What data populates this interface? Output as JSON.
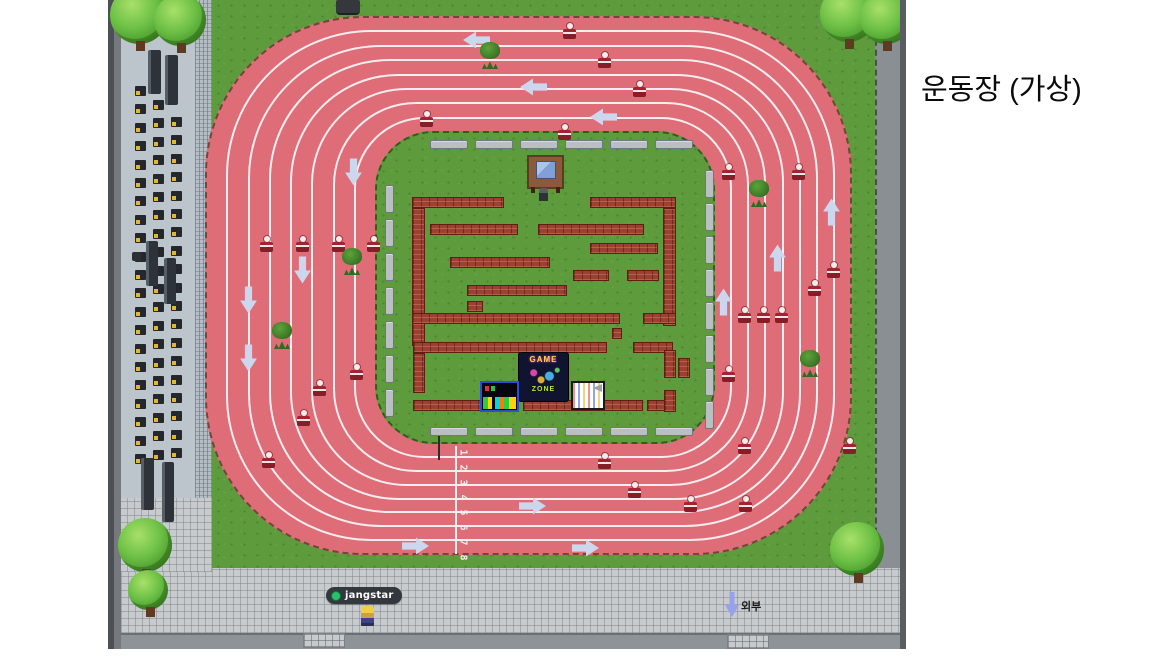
{
  "title": {
    "text": "운동장 (가상)"
  },
  "player": {
    "name": "jangstar",
    "status_color": "#27c06b"
  },
  "exit": {
    "label": "외부"
  },
  "sign": {
    "game": "GAME",
    "zone": "ZONE"
  },
  "track": {
    "lanes": 8,
    "lane_numbers": [
      "1",
      "2",
      "3",
      "4",
      "5",
      "6",
      "7",
      "8"
    ],
    "number_x": 352,
    "number_y0": 447,
    "number_step": 15
  },
  "colors": {
    "track": "#df6d78",
    "grass": "#5d9b3d",
    "lane": "#f6edef",
    "arrow": "#ccd7ee",
    "hurdle": "#a32430",
    "brick": "#9c4132",
    "status": "#27c06b"
  },
  "sprites": {
    "hurdles": [
      [
        455,
        27
      ],
      [
        490,
        56
      ],
      [
        525,
        85
      ],
      [
        312,
        115
      ],
      [
        450,
        128
      ],
      [
        152,
        240
      ],
      [
        188,
        240
      ],
      [
        224,
        240
      ],
      [
        259,
        240
      ],
      [
        242,
        368
      ],
      [
        205,
        384
      ],
      [
        189,
        414
      ],
      [
        154,
        456
      ],
      [
        490,
        457
      ],
      [
        520,
        486
      ],
      [
        576,
        500
      ],
      [
        631,
        500
      ],
      [
        614,
        168
      ],
      [
        684,
        168
      ],
      [
        719,
        266
      ],
      [
        700,
        284
      ],
      [
        630,
        311
      ],
      [
        649,
        311
      ],
      [
        667,
        311
      ],
      [
        614,
        370
      ],
      [
        630,
        442
      ],
      [
        735,
        442
      ]
    ],
    "arrows": [
      {
        "d": "left",
        "x": 355,
        "y": 30
      },
      {
        "d": "left",
        "x": 412,
        "y": 77
      },
      {
        "d": "left",
        "x": 482,
        "y": 107
      },
      {
        "d": "down",
        "x": 232,
        "y": 162
      },
      {
        "d": "down",
        "x": 181,
        "y": 260
      },
      {
        "d": "down",
        "x": 127,
        "y": 290
      },
      {
        "d": "down",
        "x": 127,
        "y": 348
      },
      {
        "d": "right",
        "x": 294,
        "y": 536
      },
      {
        "d": "right",
        "x": 411,
        "y": 496
      },
      {
        "d": "right",
        "x": 464,
        "y": 538
      },
      {
        "d": "up",
        "x": 710,
        "y": 202
      },
      {
        "d": "up",
        "x": 656,
        "y": 248
      },
      {
        "d": "up",
        "x": 602,
        "y": 292
      }
    ],
    "bushes": [
      [
        372,
        42
      ],
      [
        234,
        248
      ],
      [
        164,
        322
      ],
      [
        641,
        180
      ],
      [
        692,
        350
      ]
    ],
    "trees": [
      [
        2,
        -14,
        58
      ],
      [
        46,
        -6,
        52
      ],
      [
        712,
        -14,
        56
      ],
      [
        752,
        -8,
        52
      ],
      [
        10,
        518,
        54
      ],
      [
        20,
        570,
        40
      ],
      [
        722,
        522,
        54
      ]
    ],
    "pillars": [
      [
        40,
        50,
        13,
        44
      ],
      [
        57,
        55,
        13,
        50
      ],
      [
        38,
        241,
        12,
        45
      ],
      [
        56,
        258,
        12,
        46
      ],
      [
        33,
        458,
        13,
        52
      ],
      [
        54,
        462,
        12,
        60
      ]
    ],
    "seats": {
      "step": 18.4,
      "cols": [
        {
          "x": 27,
          "y0": 86,
          "n": 21
        },
        {
          "x": 45,
          "y0": 100,
          "n": 20
        },
        {
          "x": 63,
          "y0": 117,
          "n": 19
        }
      ]
    },
    "benches": {
      "top": {
        "y": 140,
        "xs": [
          322,
          367,
          412,
          457,
          502,
          547
        ],
        "w": 38,
        "h": 9
      },
      "bottom": {
        "y": 427,
        "xs": [
          322,
          367,
          412,
          457,
          502,
          547
        ],
        "w": 38,
        "h": 9
      },
      "left": {
        "x": 277,
        "ys": [
          185,
          219,
          253,
          287,
          321,
          355,
          389
        ],
        "w": 9,
        "h": 28
      },
      "right": {
        "x": 597,
        "ys": [
          170,
          203,
          236,
          269,
          302,
          335,
          368,
          401
        ],
        "w": 9,
        "h": 28
      }
    },
    "bricks": [
      [
        304,
        197,
        92,
        11
      ],
      [
        482,
        197,
        86,
        11
      ],
      [
        304,
        208,
        13,
        138
      ],
      [
        555,
        208,
        13,
        118
      ],
      [
        322,
        224,
        88,
        11
      ],
      [
        430,
        224,
        106,
        11
      ],
      [
        482,
        243,
        68,
        11
      ],
      [
        342,
        257,
        100,
        11
      ],
      [
        465,
        270,
        36,
        11
      ],
      [
        519,
        270,
        32,
        11
      ],
      [
        359,
        285,
        100,
        11
      ],
      [
        359,
        301,
        16,
        11
      ],
      [
        304,
        313,
        208,
        11
      ],
      [
        535,
        313,
        33,
        11
      ],
      [
        504,
        328,
        10,
        11
      ],
      [
        305,
        342,
        194,
        11
      ],
      [
        525,
        342,
        40,
        11
      ],
      [
        305,
        353,
        12,
        40
      ],
      [
        556,
        350,
        12,
        28
      ],
      [
        570,
        358,
        12,
        20
      ],
      [
        305,
        400,
        104,
        11
      ],
      [
        415,
        400,
        120,
        11
      ],
      [
        539,
        400,
        27,
        11
      ],
      [
        556,
        390,
        12,
        22
      ]
    ],
    "gates": [
      [
        195,
        633,
        42,
        15
      ],
      [
        619,
        634,
        42,
        15
      ]
    ]
  }
}
